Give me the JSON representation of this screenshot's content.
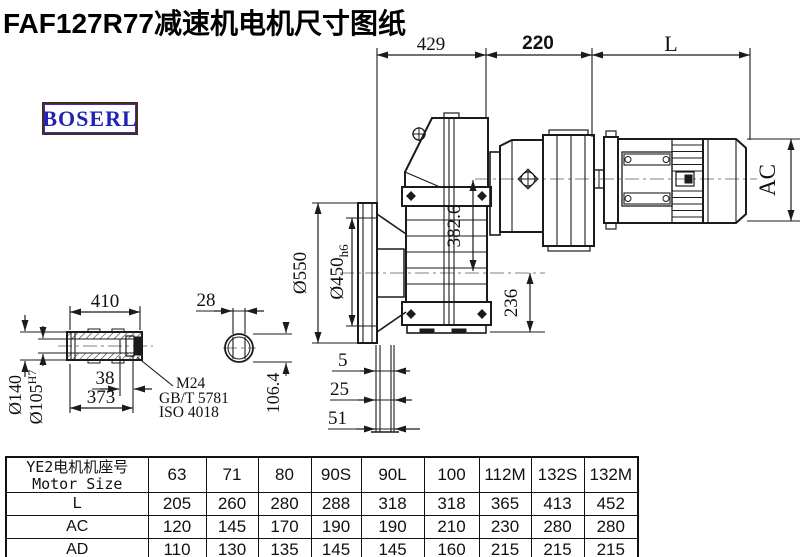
{
  "title": "FAF127R77减速机电机尺寸图纸",
  "logo": {
    "text": "BOSERL"
  },
  "drawing": {
    "top_dims": {
      "d429": "429",
      "d220": "220",
      "dL": "L"
    },
    "motor": {
      "ac": "AC"
    },
    "flange": {
      "dia_outer": "Ø550",
      "dia_inner": "Ø450",
      "dia_inner_sub": "h6",
      "off5": "5",
      "off25": "25",
      "off51": "51"
    },
    "center": {
      "axis_dist": "382.6",
      "bottom_height": "236"
    },
    "shaft": {
      "len": "410",
      "d38": "38",
      "d373": "373",
      "dia140": "Ø140",
      "dia105": "Ø105",
      "dia105_sup": "H7",
      "bolt": "M24",
      "std1": "GB/T 5781",
      "std2": "ISO 4018"
    },
    "end_view": {
      "d28": "28",
      "d106": "106.4"
    }
  },
  "table": {
    "header_cn": "YE2电机机座号",
    "header_en": "Motor Size",
    "columns": [
      "63",
      "71",
      "80",
      "90S",
      "90L",
      "100",
      "112M",
      "132S",
      "132M"
    ],
    "rows": [
      {
        "label": "L",
        "values": [
          "205",
          "260",
          "280",
          "288",
          "318",
          "318",
          "365",
          "413",
          "452"
        ]
      },
      {
        "label": "AC",
        "values": [
          "120",
          "145",
          "170",
          "190",
          "190",
          "210",
          "230",
          "280",
          "280"
        ]
      },
      {
        "label": "AD",
        "values": [
          "110",
          "130",
          "135",
          "145",
          "145",
          "160",
          "215",
          "215",
          "215"
        ]
      }
    ]
  },
  "colors": {
    "line": "#1b1b1b",
    "centerline": "#808080",
    "logo_text": "#2222b5",
    "logo_border": "#4a2a1d"
  }
}
